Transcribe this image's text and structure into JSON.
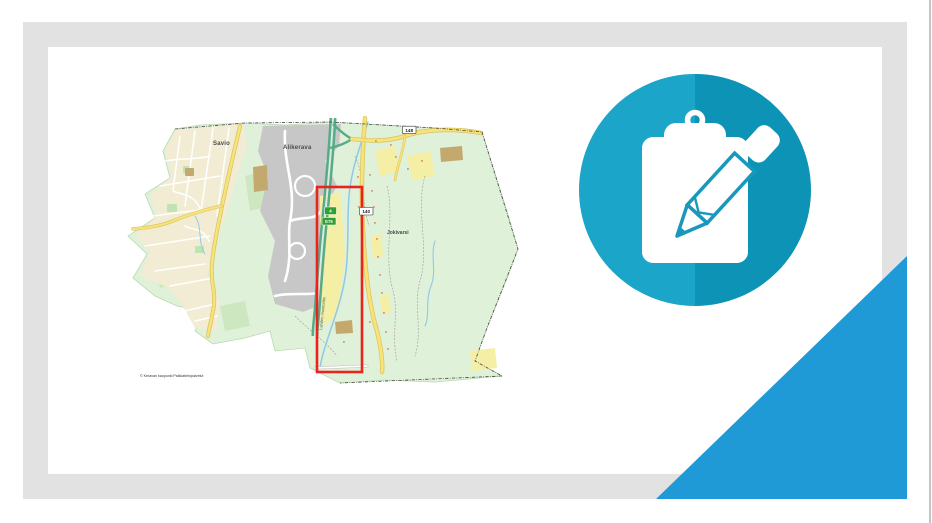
{
  "page": {
    "background": "#FFFFFF",
    "frame_color": "#E2E2E2",
    "right_edge_line_color": "#C4C4C4",
    "accent_triangle_color": "#1F9AD6"
  },
  "map": {
    "copyright": "© Keravan kaupunki Paikkatietopalvelut",
    "area_labels": {
      "savio": "Savio",
      "alikerava": "Alikerava",
      "jokivarsi": "Jokivarsi"
    },
    "highway_label": "Lahden moottoritie",
    "badges": {
      "motorway": "4",
      "e_route": "E75",
      "road_140": "140",
      "road_148": "148"
    },
    "highlight_rect_color": "#E8241D",
    "colors": {
      "municipality_fill": "#DFF1D8",
      "built_area": "#F1ECD3",
      "industrial_area": "#C7C7C7",
      "main_road": "#F8E27A",
      "motorway_green": "#57AB88",
      "water": "#8FC8E8",
      "field_yellow": "#F5EFA6",
      "green_badge": "#2F9E33"
    }
  },
  "icon": {
    "semantic": "clipboard-with-pencil",
    "circle_left_color": "#1BA5C8",
    "circle_right_color": "#0D93B5",
    "glyph_color": "#FFFFFF",
    "pencil_outline_color": "#1898BC"
  }
}
